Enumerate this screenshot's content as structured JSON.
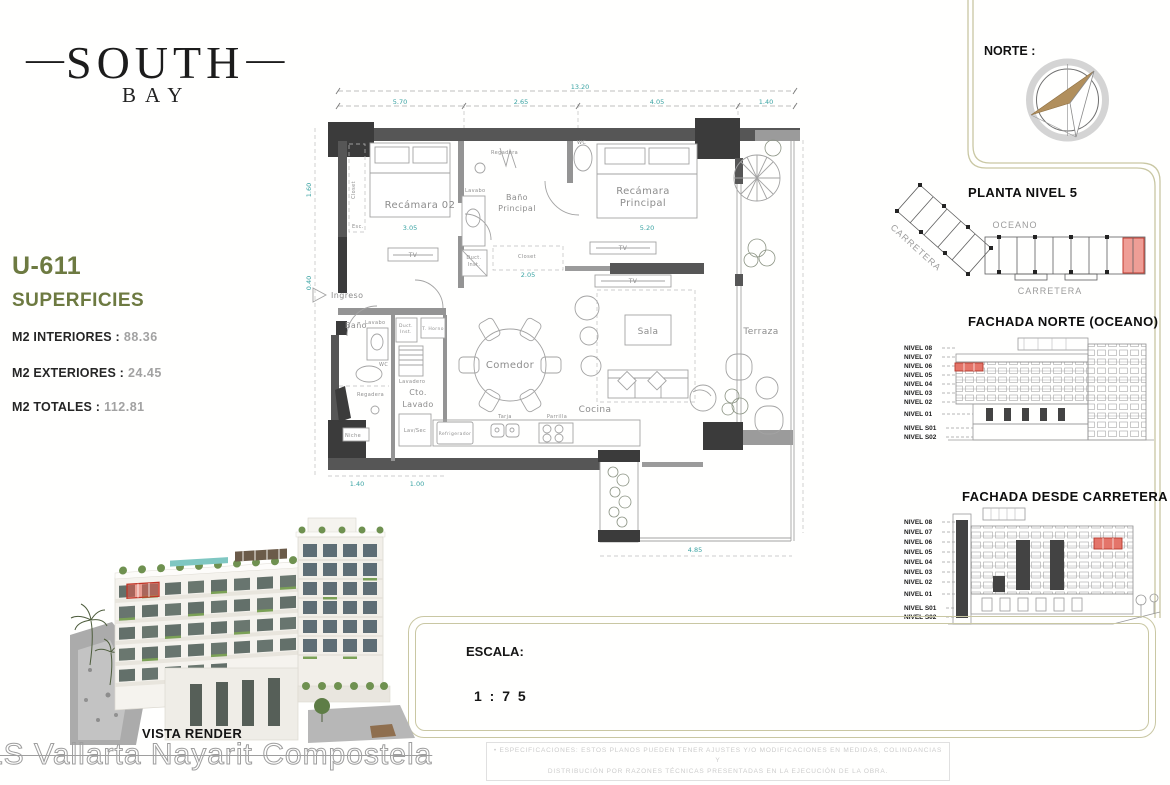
{
  "brand": {
    "prefix": "—",
    "name": "SOUTH",
    "suffix": "—",
    "sub": "BAY"
  },
  "unit": {
    "id": "U-611",
    "section": "SUPERFICIES",
    "metrics": [
      {
        "label": "M2 INTERIORES :",
        "value": "88.36"
      },
      {
        "label": "M2 EXTERIORES :",
        "value": "24.45"
      },
      {
        "label": "M2 TOTALES :",
        "value": "112.81"
      }
    ]
  },
  "plan": {
    "rooms": {
      "recamara02": "Recámara 02",
      "bano_principal": [
        "Baño",
        "Principal"
      ],
      "recamara_principal": [
        "Recámara",
        "Principal"
      ],
      "ingreso": "Ingreso",
      "bano": "Baño",
      "cto_lavado": [
        "Cto.",
        "Lavado"
      ],
      "comedor": "Comedor",
      "cocina": "Cocina",
      "sala": "Sala",
      "terraza": "Terraza"
    },
    "fixtures": {
      "closet": "Closet",
      "esc": "Esc.",
      "tv": "TV",
      "regadera": "Regadera",
      "wc": "WC",
      "lavabo": "Lavabo",
      "duct": [
        "Duct.",
        "Inst."
      ],
      "t_horno": "T. Horno",
      "lavadero": "Lavadero",
      "lav_sec": "Lav/Sec",
      "niche": "Niche",
      "refrigerador": "Refrigerador",
      "tarja": "Tarja",
      "parrilla": "Parrilla"
    },
    "dims": {
      "total": "13.20",
      "top": [
        "5.70",
        "2.65",
        "4.05",
        "1.40"
      ],
      "left": [
        "1.60",
        "0.40"
      ],
      "bottom": [
        "1.40",
        "1.00",
        "4.85"
      ],
      "inner": [
        "3.05",
        "5.20",
        "2.05"
      ]
    }
  },
  "norte": {
    "label": "NORTE :"
  },
  "keyplan": {
    "title": "PLANTA  NIVEL 5",
    "oceano": "OCEANO",
    "carretera": "CARRETERA"
  },
  "fachadas": {
    "norte_title": "FACHADA  NORTE  (OCEANO)",
    "carretera_title": "FACHADA  DESDE  CARRETERA",
    "levels": [
      "NIVEL 08",
      "NIVEL 07",
      "NIVEL 06",
      "NIVEL 05",
      "NIVEL 04",
      "NIVEL 03",
      "NIVEL 02",
      "NIVEL 01",
      "NIVEL S01",
      "NIVEL S02"
    ]
  },
  "escala": {
    "label": "ESCALA:",
    "value": "1 : 7 5"
  },
  "render": {
    "caption": "VISTA RENDER",
    "watermark": "LS Vallarta Nayarit Compostela"
  },
  "disclaimer": {
    "line1": "• ESPECIFICACIONES: ESTOS PLANOS PUEDEN TENER AJUSTES Y/O MODIFICACIONES EN MEDIDAS, COLINDANCIAS Y",
    "line2": "DISTRIBUCIÓN POR RAZONES TÉCNICAS PRESENTADAS EN LA EJECUCIÓN DE LA OBRA."
  },
  "colors": {
    "accent_green": "#6d7a41",
    "gold_border": "#c9c7a3",
    "highlight_red": "#e4756a",
    "highlight_red_stroke": "#b6392d",
    "dim_teal": "#3aa3a3",
    "wall_gray": "#565656"
  }
}
